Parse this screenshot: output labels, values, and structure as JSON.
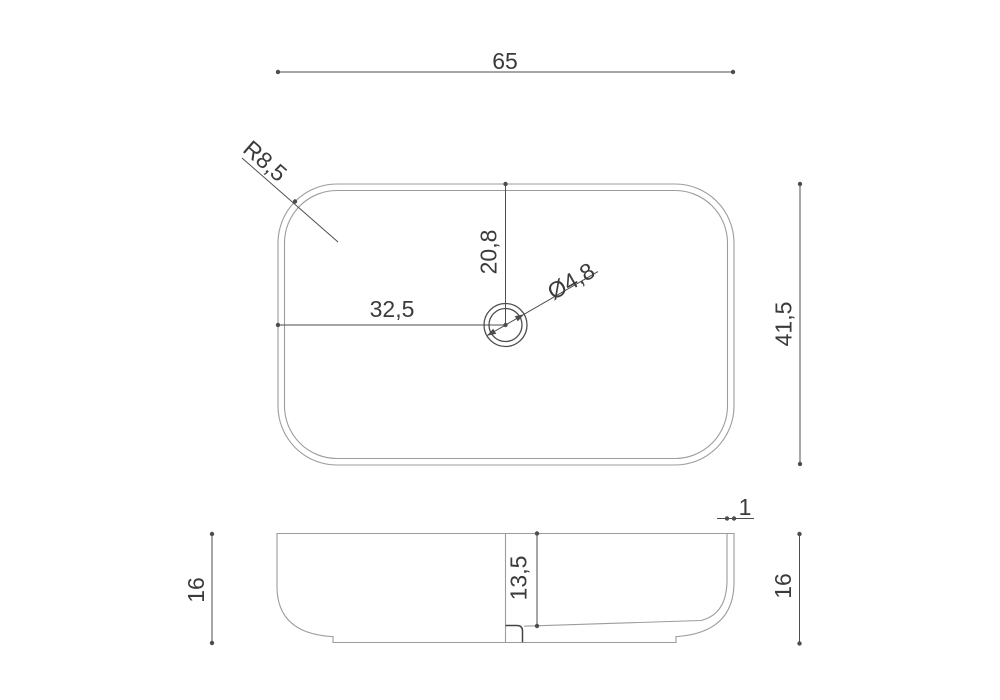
{
  "colors": {
    "background": "#ffffff",
    "outline": "#9c9c9c",
    "dimension": "#4d4d4d",
    "dimension_dark": "#444444",
    "text": "#3b3b3b"
  },
  "top_view": {
    "width": "65",
    "depth": "41,5",
    "corner_radius": "R8,5",
    "drain_offset_left": "32,5",
    "drain_offset_top": "20,8",
    "drain_diameter": "Ø4,8"
  },
  "side_view": {
    "height_left": "16",
    "height_right": "16",
    "inner_depth": "13,5",
    "wall_thickness": "1"
  }
}
